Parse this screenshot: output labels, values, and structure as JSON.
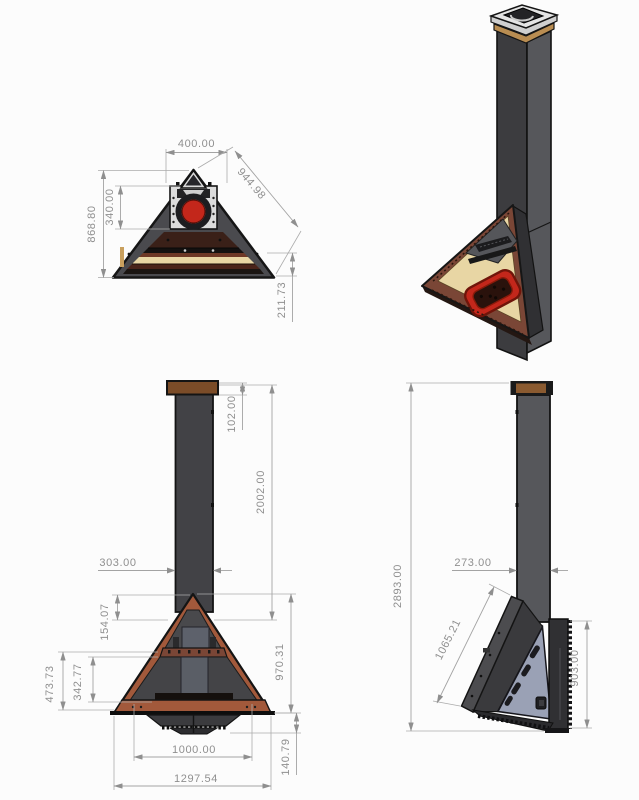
{
  "drawing": {
    "type": "cad-multiview-fireplace",
    "views": [
      "top-view",
      "isometric-view",
      "front-view",
      "side-view"
    ]
  },
  "dims": {
    "top": {
      "width": "400.00",
      "slope": "944.98",
      "depth": "868.80",
      "flue_offset": "340.00",
      "corner_offset": "211.73"
    },
    "front": {
      "cap_height": "102.00",
      "chimney_height": "2002.00",
      "chimney_width": "303.00",
      "apex_to_flue": "154.07",
      "opening_height": "473.73",
      "inner_opening": "342.77",
      "firebox_height": "970.31",
      "hearth_width": "1000.00",
      "base_width": "1297.54",
      "grate_height": "140.79"
    },
    "side": {
      "overall_height": "2893.00",
      "chimney_depth": "273.00",
      "slope_length": "1065.21",
      "back_height": "903.00"
    }
  },
  "colors": {
    "background": "#fcfcfc",
    "steel_dark": "#424246",
    "steel_medium": "#56575b",
    "steel_face": "#4a4a4e",
    "steel_light": "#dcdcdc",
    "copper": "#a2593b",
    "copper_dark": "#7a4636",
    "wood_tan": "#e8d6a4",
    "cap_brown": "#7b4c28",
    "flame_red": "#c3271b",
    "coal_dark": "#2a120c",
    "panel_blue": "#9aa1b5",
    "dim_gray": "#8f8f8f",
    "outline": "#141414"
  }
}
